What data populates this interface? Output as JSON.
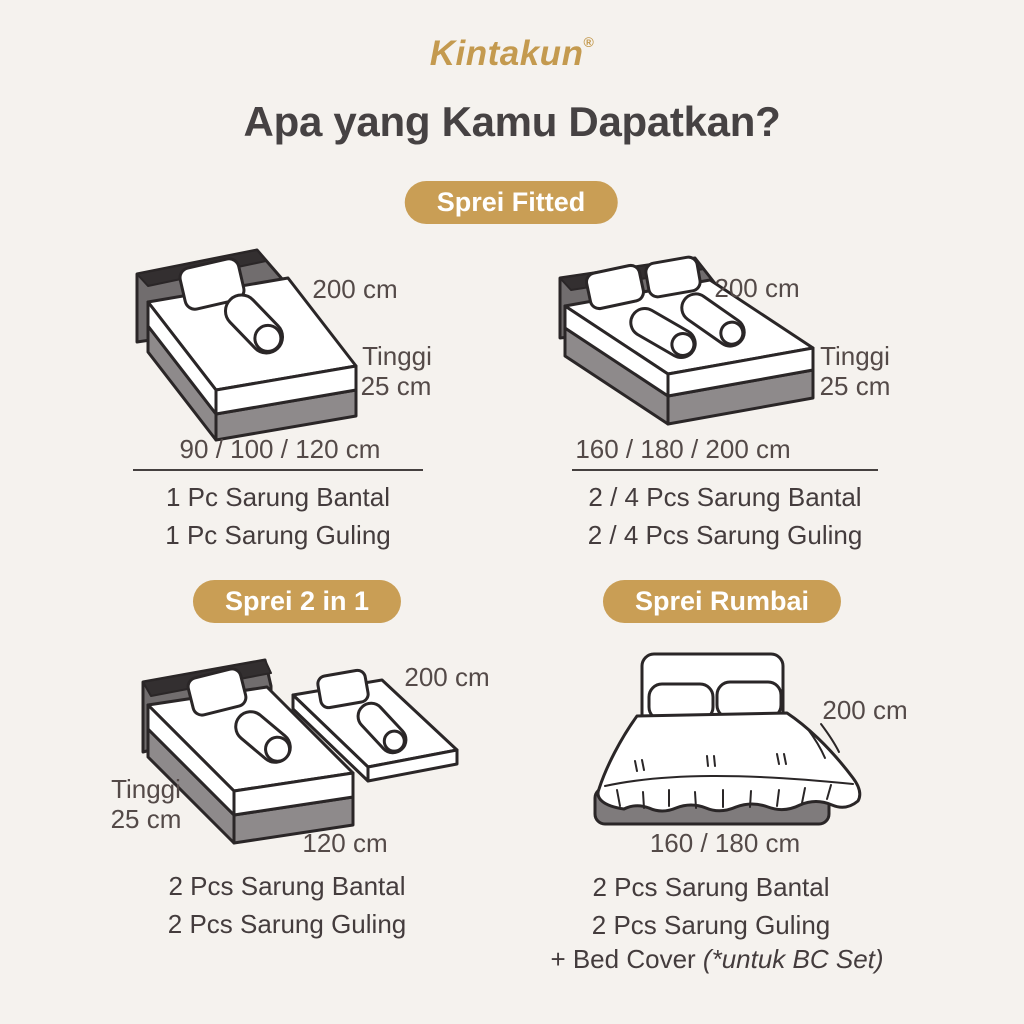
{
  "brand": {
    "name": "Kintakun",
    "registered_mark": "®"
  },
  "title": "Apa yang Kamu Dapatkan?",
  "colors": {
    "background": "#f5f2ee",
    "accent_gold": "#c99e55",
    "logo_gold": "#c49a4f",
    "title_text": "#464243",
    "body_text": "#443c3d"
  },
  "badges": {
    "fitted": "Sprei Fitted",
    "two_in_one": "Sprei 2 in 1",
    "rumbai": "Sprei Rumbai"
  },
  "fitted_single": {
    "width_label": "200 cm",
    "height_label_line1": "Tinggi",
    "height_label_line2": "25 cm",
    "sizes": "90 / 100 / 120 cm",
    "items": [
      "1 Pc Sarung Bantal",
      "1 Pc Sarung Guling"
    ]
  },
  "fitted_double": {
    "width_label": "200 cm",
    "height_label_line1": "Tinggi",
    "height_label_line2": "25 cm",
    "sizes": "160 / 180 / 200 cm",
    "items": [
      "2 / 4 Pcs Sarung Bantal",
      "2 / 4 Pcs Sarung Guling"
    ]
  },
  "two_in_one": {
    "width_label": "200 cm",
    "height_label_line1": "Tinggi",
    "height_label_line2": "25 cm",
    "length_label": "120 cm",
    "items": [
      "2 Pcs Sarung Bantal",
      "2 Pcs Sarung Guling"
    ]
  },
  "rumbai": {
    "width_label": "200 cm",
    "sizes": "160 / 180 cm",
    "items": [
      "2 Pcs Sarung Bantal",
      "2 Pcs Sarung Guling"
    ],
    "bc_prefix": "+ Bed Cover ",
    "bc_note": "(*untuk BC Set)"
  }
}
